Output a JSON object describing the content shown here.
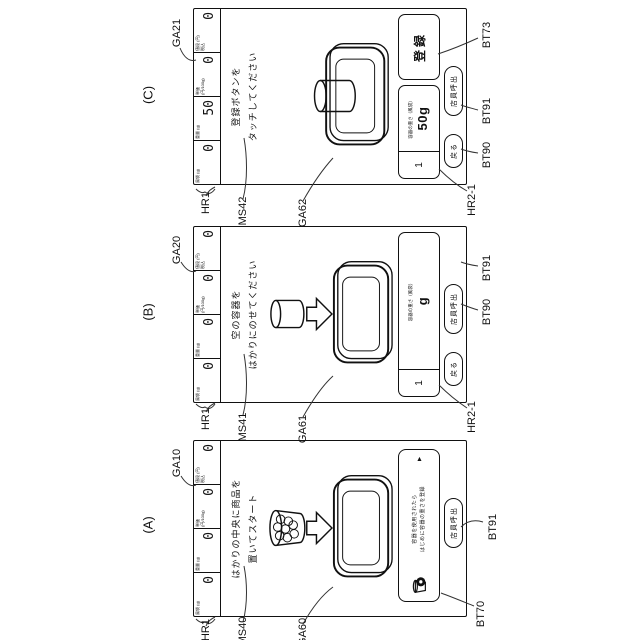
{
  "figure_labels": {
    "caption_a": "(A)",
    "caption_b": "(B)",
    "caption_c": "(C)",
    "refs": {
      "ga10": "GA10",
      "ga20": "GA20",
      "ga21": "GA21",
      "ga60": "GA60",
      "ga61": "GA61",
      "ga62": "GA62",
      "ms40": "MS40",
      "ms41": "MS41",
      "ms42": "MS42",
      "hr1": "HR1",
      "hr2_1": "HR2-1",
      "bt70": "BT70",
      "bt73": "BT73",
      "bt90": "BT90",
      "bt91": "BT91"
    }
  },
  "ui": {
    "header_labels": [
      "風袋 (g)",
      "重量 (g)",
      "単価 (円/100g)",
      "値段 (円) 税込"
    ],
    "buttons": {
      "register": "登録",
      "back": "戻る",
      "staff_call": "店員呼出"
    },
    "tare_index": "1",
    "tare_label": "容器の重さ（風袋）",
    "screens": {
      "a": {
        "header_values": [
          "0",
          "0",
          "0",
          "0"
        ],
        "message": [
          "はかりの中央に商品を",
          "置いてスタート"
        ],
        "banner": {
          "line1": "容器を使用されたら",
          "line2": "はじめに容器の重さを登録",
          "expand": "▲"
        }
      },
      "b": {
        "header_values": [
          "0",
          "0",
          "0",
          "0"
        ],
        "message": [
          "空の容器を",
          "はかりにのせてください"
        ],
        "tare_value": "g"
      },
      "c": {
        "header_values": [
          "0",
          "50",
          "0",
          "0"
        ],
        "message": [
          "登録ボタンを",
          "タッチしてください"
        ],
        "tare_value": "50g"
      }
    }
  }
}
